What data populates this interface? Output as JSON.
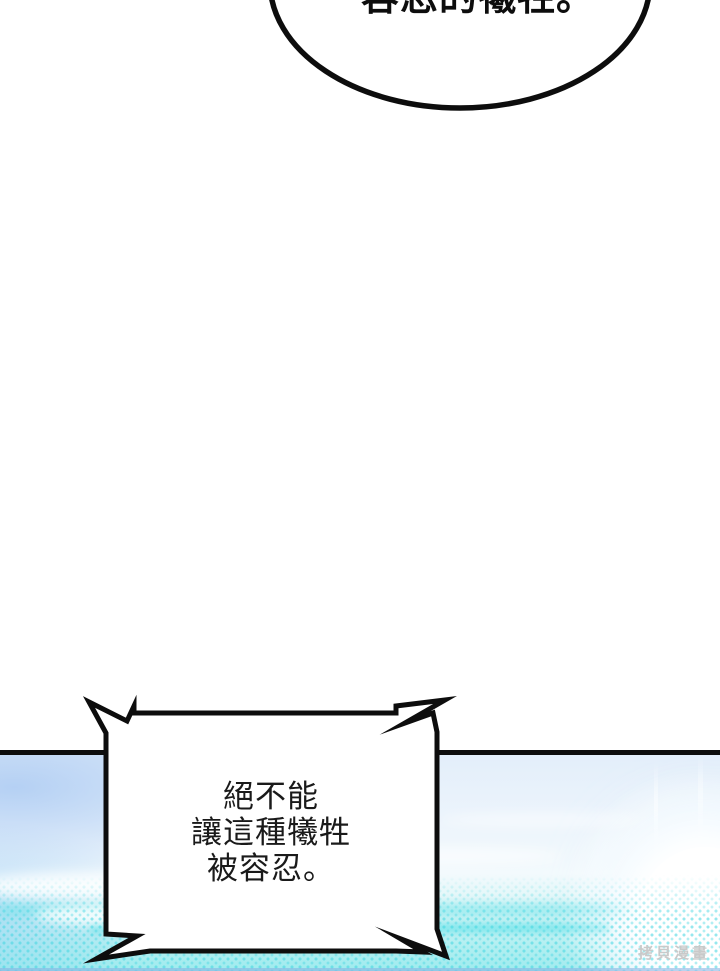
{
  "top_bubble": {
    "text": "容忍的犧牲。"
  },
  "bottom_bubble": {
    "lines": [
      "絕不能",
      "讓這種犧牲",
      "被容忍。"
    ]
  },
  "watermark": {
    "text": "拷貝漫畫"
  },
  "colors": {
    "ink": "#0d0d0d",
    "sky_blue": "#cfe3f8",
    "cyan": "#9febee",
    "watermark_gray": "#c9c9c9"
  }
}
